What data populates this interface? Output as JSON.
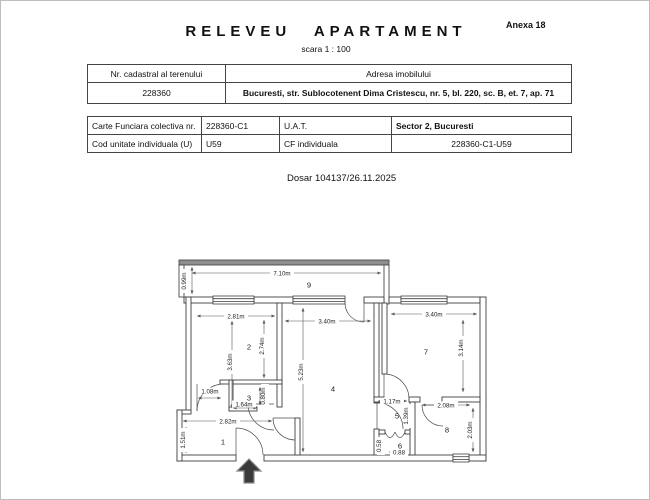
{
  "header": {
    "title": "RELEVEU APARTAMENT",
    "annex": "Anexa 18",
    "scale": "scara 1 : 100"
  },
  "dosar": "Dosar 104137/26.11.2025",
  "table1": {
    "headers": [
      "Nr. cadastral al terenului",
      "Adresa imobilului"
    ],
    "row": [
      "228360",
      "Bucuresti, str. Sublocotenent Dima Cristescu, nr. 5, bl. 220, sc. B, et. 7, ap. 71"
    ]
  },
  "table2": {
    "rows": [
      [
        "Carte Funciara colectiva nr.",
        "228360-C1",
        "U.A.T.",
        "Sector 2, Bucuresti"
      ],
      [
        "Cod unitate individuala (U)",
        "U59",
        "CF individuala",
        "228360-C1-U59"
      ]
    ]
  },
  "plan": {
    "room_numbers": [
      "1",
      "2",
      "3",
      "4",
      "5",
      "6",
      "7",
      "8",
      "9"
    ],
    "dims": {
      "balcony_w": "7.10m",
      "balcony_d": "0.99m",
      "r2_w": "2.81m",
      "r2_h_left": "3.63m",
      "r2_h_right": "2.74m",
      "r4_w": "3.40m",
      "r4_h": "5.23m",
      "r7_w": "3.40m",
      "r7_h": "3.14m",
      "hall_door": "1.08m",
      "r3_w": "1.64m",
      "r3_h": "0.80m",
      "r1_w": "2.82m",
      "r1_h": "1.51m",
      "r5_w": "1.17m",
      "r5_h": "1.39m",
      "r6_h": "0.58",
      "r6_w": "0.88",
      "r8_w": "2.08m",
      "r8_h": "2.03m"
    }
  }
}
